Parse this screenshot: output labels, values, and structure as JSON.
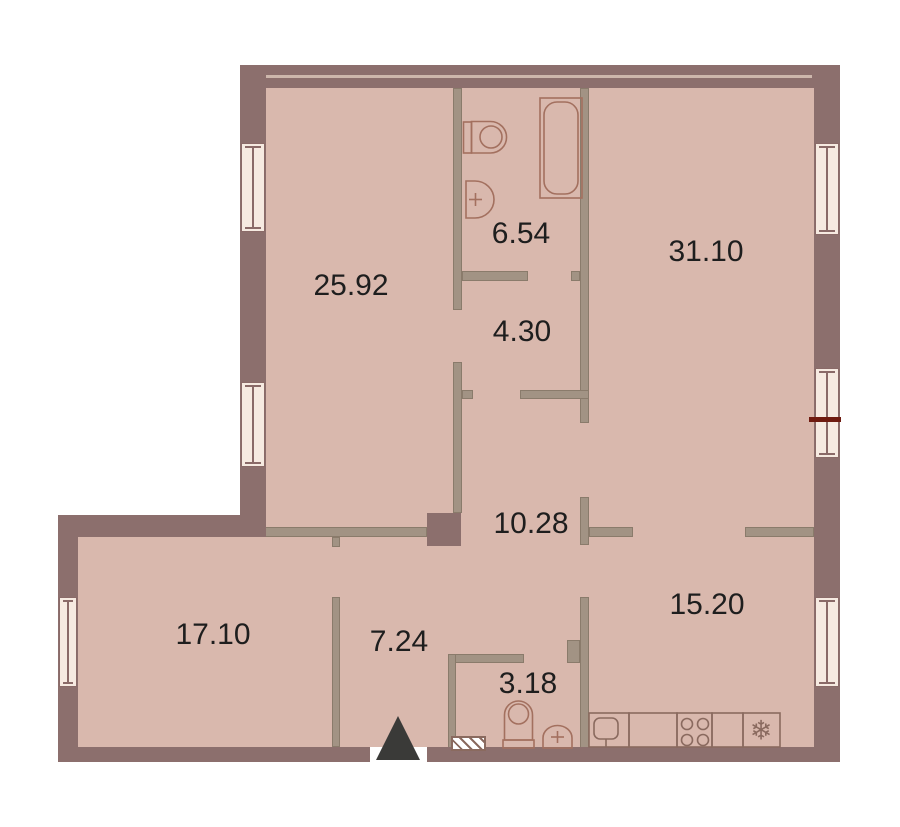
{
  "plan": {
    "type": "apartment-floor-plan",
    "rooms": [
      {
        "id": "room-top-left",
        "area": "25.92"
      },
      {
        "id": "bathroom",
        "area": "6.54"
      },
      {
        "id": "room-top-right",
        "area": "31.10"
      },
      {
        "id": "hall-upper",
        "area": "4.30"
      },
      {
        "id": "corridor",
        "area": "10.28"
      },
      {
        "id": "kitchen-living",
        "area": "15.20"
      },
      {
        "id": "room-bottom-left",
        "area": "17.10"
      },
      {
        "id": "hallway",
        "area": "7.24"
      },
      {
        "id": "wc",
        "area": "3.18"
      }
    ]
  },
  "icons": {
    "fridge_glyph": "❄"
  },
  "colors": {
    "outer_wall": "#8c6f6d",
    "outer_wall_edge": "#6e5653",
    "partition": "#a29384",
    "partition_edge": "#8a7b6b",
    "floor": "#d9b8ad",
    "window_fill": "#f6eae1",
    "window_edge": "#8a6a68",
    "fixture_stroke": "#a3705f",
    "kitchen_stroke": "#8a6a5f",
    "red_mark": "#6f1b10",
    "entry_arrow": "#3a3a38",
    "label_text": "#1e1e1e",
    "top_wall_line": "#cdb7ac"
  }
}
